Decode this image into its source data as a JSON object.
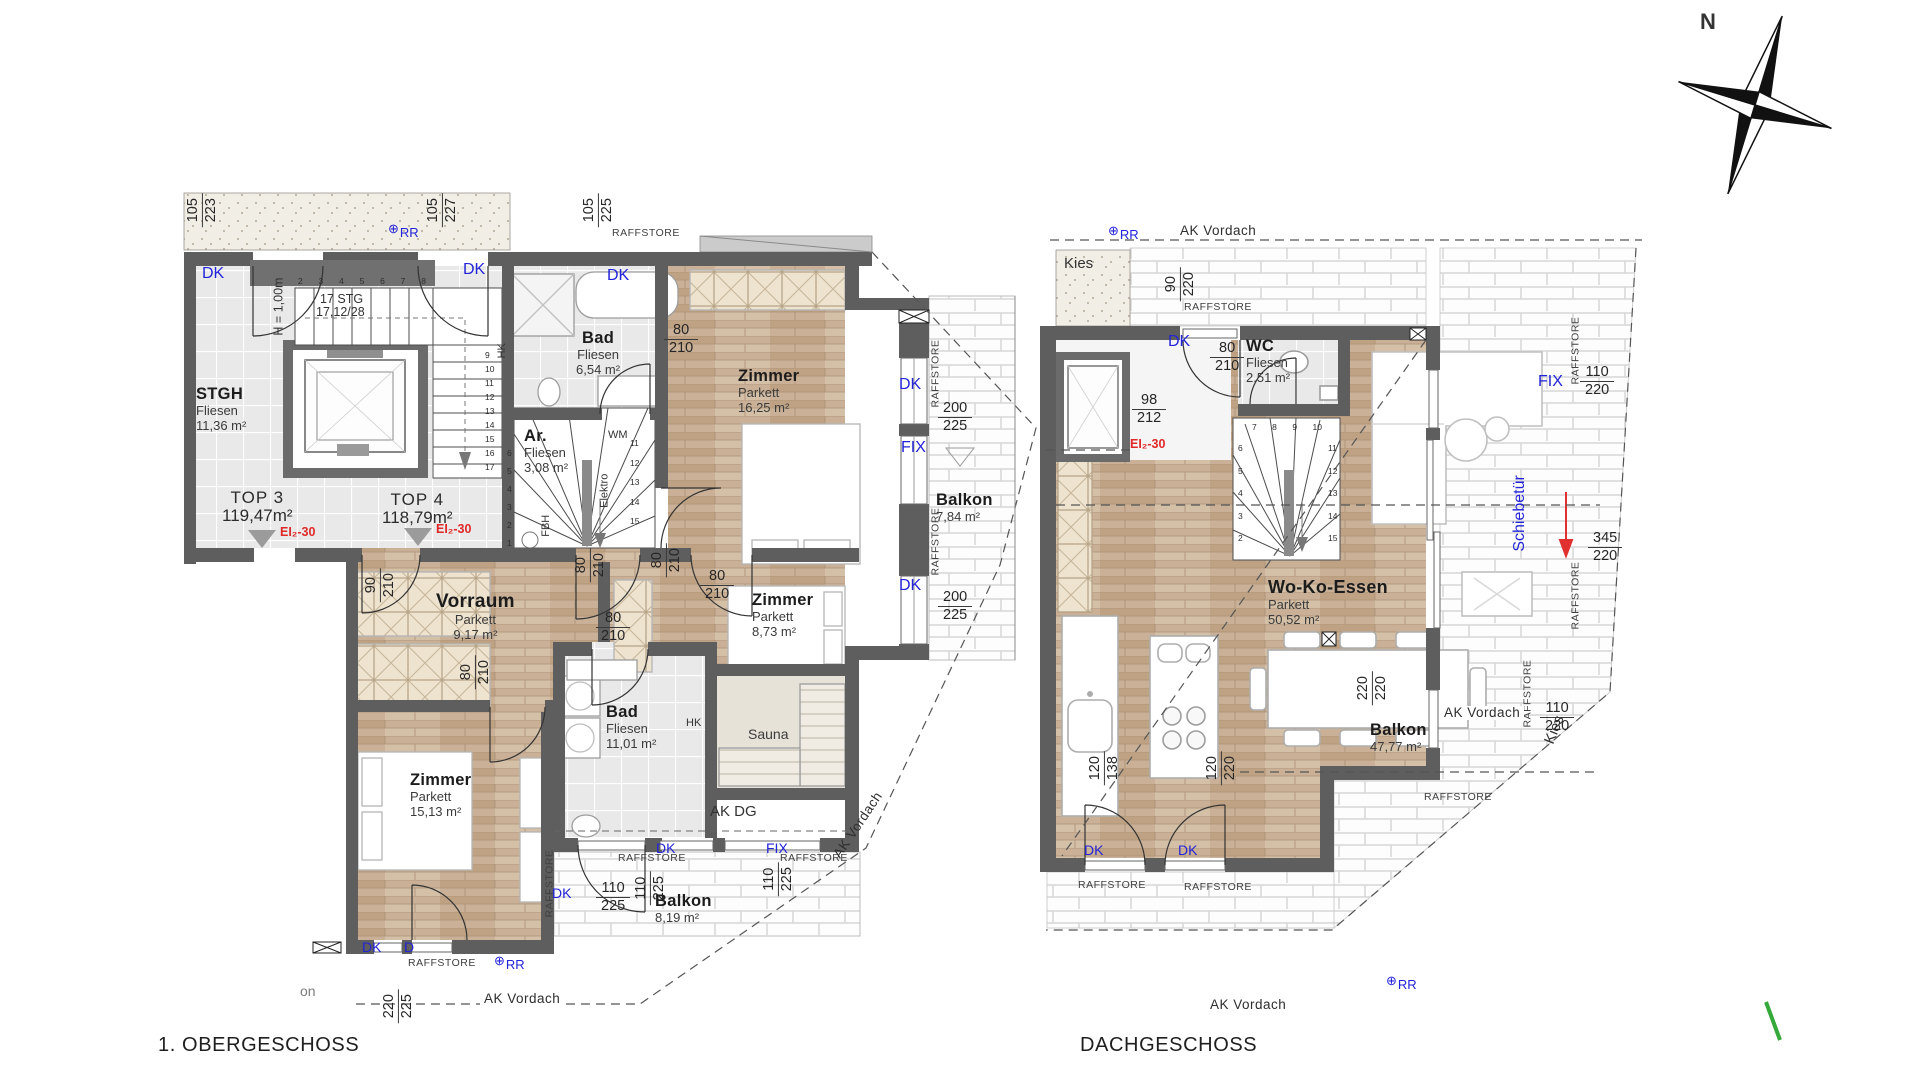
{
  "titles": {
    "og": "1. OBERGESCHOSS",
    "dg": "DACHGESCHOSS"
  },
  "compass": {
    "north": "N"
  },
  "annot": {
    "dk": "DK",
    "d": "D",
    "fix": "FIX",
    "rr": "RR",
    "rr_symbol": "⊕",
    "raffstore": "RAFFSTORE",
    "ak_vordach": "AK Vordach",
    "ak_dg": "AK DG",
    "ei": "EI₂-30",
    "kies": "Kies",
    "schiebetuer": "Schiebetür",
    "hk": "HK",
    "wm": "WM",
    "fbh": "FBH",
    "elektro": "Elektro",
    "stg_count": "17 STG",
    "stg_dim": "17,12/28",
    "h_note": "H = 1,00m",
    "partial_on": "on"
  },
  "og": {
    "rooms": {
      "stgh": {
        "name": "STGH",
        "mat": "Fliesen",
        "area": "11,36 m²"
      },
      "bad1": {
        "name": "Bad",
        "mat": "Fliesen",
        "area": "6,54 m²"
      },
      "zimmer1": {
        "name": "Zimmer",
        "mat": "Parkett",
        "area": "16,25 m²"
      },
      "ar": {
        "name": "Ar.",
        "mat": "Fliesen",
        "area": "3,08 m²"
      },
      "vorraum": {
        "name": "Vorraum",
        "mat": "Parkett",
        "area": "9,17 m²"
      },
      "zimmer2": {
        "name": "Zimmer",
        "mat": "Parkett",
        "area": "8,73 m²"
      },
      "bad2": {
        "name": "Bad",
        "mat": "Fliesen",
        "area": "11,01 m²"
      },
      "zimmer3": {
        "name": "Zimmer",
        "mat": "Parkett",
        "area": "15,13 m²"
      },
      "sauna": {
        "name": "Sauna"
      },
      "balkon1": {
        "name": "Balkon",
        "area": "7,84 m²"
      },
      "balkon2": {
        "name": "Balkon",
        "area": "8,19 m²"
      }
    },
    "units": {
      "top3": {
        "label": "TOP 3",
        "area": "119,47m²"
      },
      "top4": {
        "label": "TOP 4",
        "area": "118,79m²"
      }
    },
    "stairs": {
      "top_run": [
        "2",
        "3",
        "4",
        "5",
        "6",
        "7",
        "8"
      ],
      "right_run": [
        "9",
        "10",
        "11",
        "12",
        "13",
        "14",
        "15",
        "16",
        "17"
      ],
      "spiral_left": [
        "6",
        "5",
        "4",
        "3",
        "2",
        "1"
      ],
      "spiral_right": [
        "11",
        "12",
        "13",
        "14",
        "15"
      ]
    }
  },
  "dg": {
    "rooms": {
      "wc": {
        "name": "WC",
        "mat": "Fliesen",
        "area": "2,51 m²"
      },
      "wke": {
        "name": "Wo-Ko-Essen",
        "mat": "Parkett",
        "area": "50,52 m²"
      },
      "balkon": {
        "name": "Balkon",
        "area": "47,77 m²"
      }
    },
    "stairs": {
      "left_run": [
        "6",
        "5",
        "4",
        "3",
        "2"
      ],
      "top_run": [
        "7",
        "8",
        "9",
        "10"
      ],
      "right_run": [
        "11",
        "12",
        "13",
        "14",
        "15"
      ]
    }
  },
  "dims_og": [
    {
      "a": "105",
      "b": "223"
    },
    {
      "a": "105",
      "b": "227"
    },
    {
      "a": "105",
      "b": "225"
    },
    {
      "a": "90",
      "b": "210"
    },
    {
      "a": "80",
      "b": "210"
    },
    {
      "a": "80",
      "b": "210"
    },
    {
      "a": "80",
      "b": "210"
    },
    {
      "a": "80",
      "b": "210"
    },
    {
      "a": "80",
      "b": "210"
    },
    {
      "a": "80",
      "b": "210"
    },
    {
      "a": "200",
      "b": "225"
    },
    {
      "a": "200",
      "b": "225"
    },
    {
      "a": "110",
      "b": "225"
    },
    {
      "a": "110",
      "b": "225"
    },
    {
      "a": "110",
      "b": "225"
    },
    {
      "a": "220",
      "b": "225"
    }
  ],
  "dims_dg": [
    {
      "a": "90",
      "b": "220"
    },
    {
      "a": "80",
      "b": "210"
    },
    {
      "a": "98",
      "b": "212"
    },
    {
      "a": "110",
      "b": "220"
    },
    {
      "a": "345",
      "b": "220"
    },
    {
      "a": "110",
      "b": "220"
    },
    {
      "a": "220",
      "b": "220"
    },
    {
      "a": "120",
      "b": "138"
    },
    {
      "a": "120",
      "b": "220"
    }
  ]
}
